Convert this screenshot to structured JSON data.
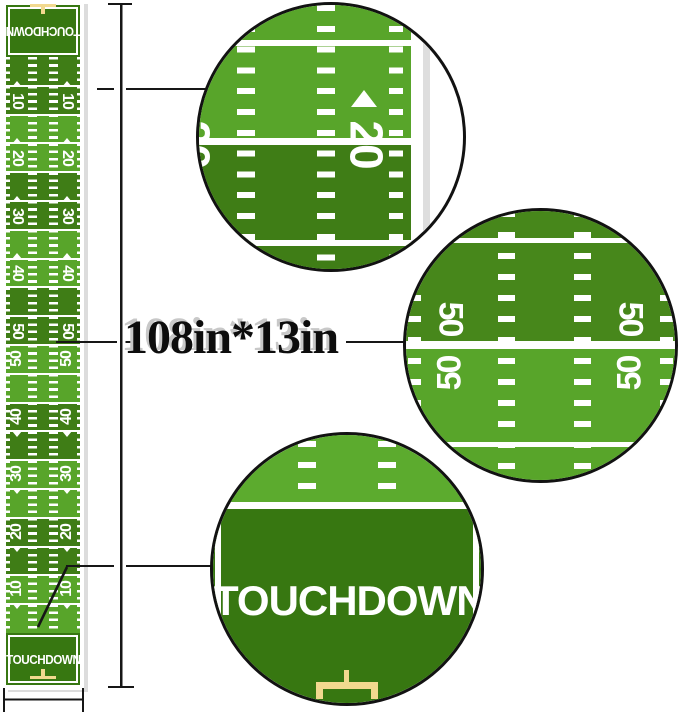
{
  "dimension_label": {
    "text": "108in*13in"
  },
  "field_runner": {
    "endzone_top_label": "TOUCHDOWN",
    "endzone_bottom_label": "TOUCHDOWN",
    "yard_labels": [
      "10",
      "20",
      "30",
      "40",
      "50"
    ],
    "yard_sequence_top_to_bottom": [
      "10",
      "20",
      "30",
      "40",
      "50",
      "50",
      "40",
      "30",
      "20",
      "10"
    ]
  },
  "detail_circles": {
    "twenty": {
      "label": "20"
    },
    "fifty": {
      "label": "50"
    },
    "endzone": {
      "label": "TOUCHDOWN"
    }
  },
  "colors": {
    "light_green": "#58a52a",
    "dark_green": "#3f7d16",
    "dark_green_circle": "#47871b",
    "light_green_circle": "#5cab2e",
    "endzone_green": "#377711",
    "field_line_white": "#ffffff",
    "goalpost_tan": "#f2d98f",
    "dimension_black": "#161616"
  }
}
